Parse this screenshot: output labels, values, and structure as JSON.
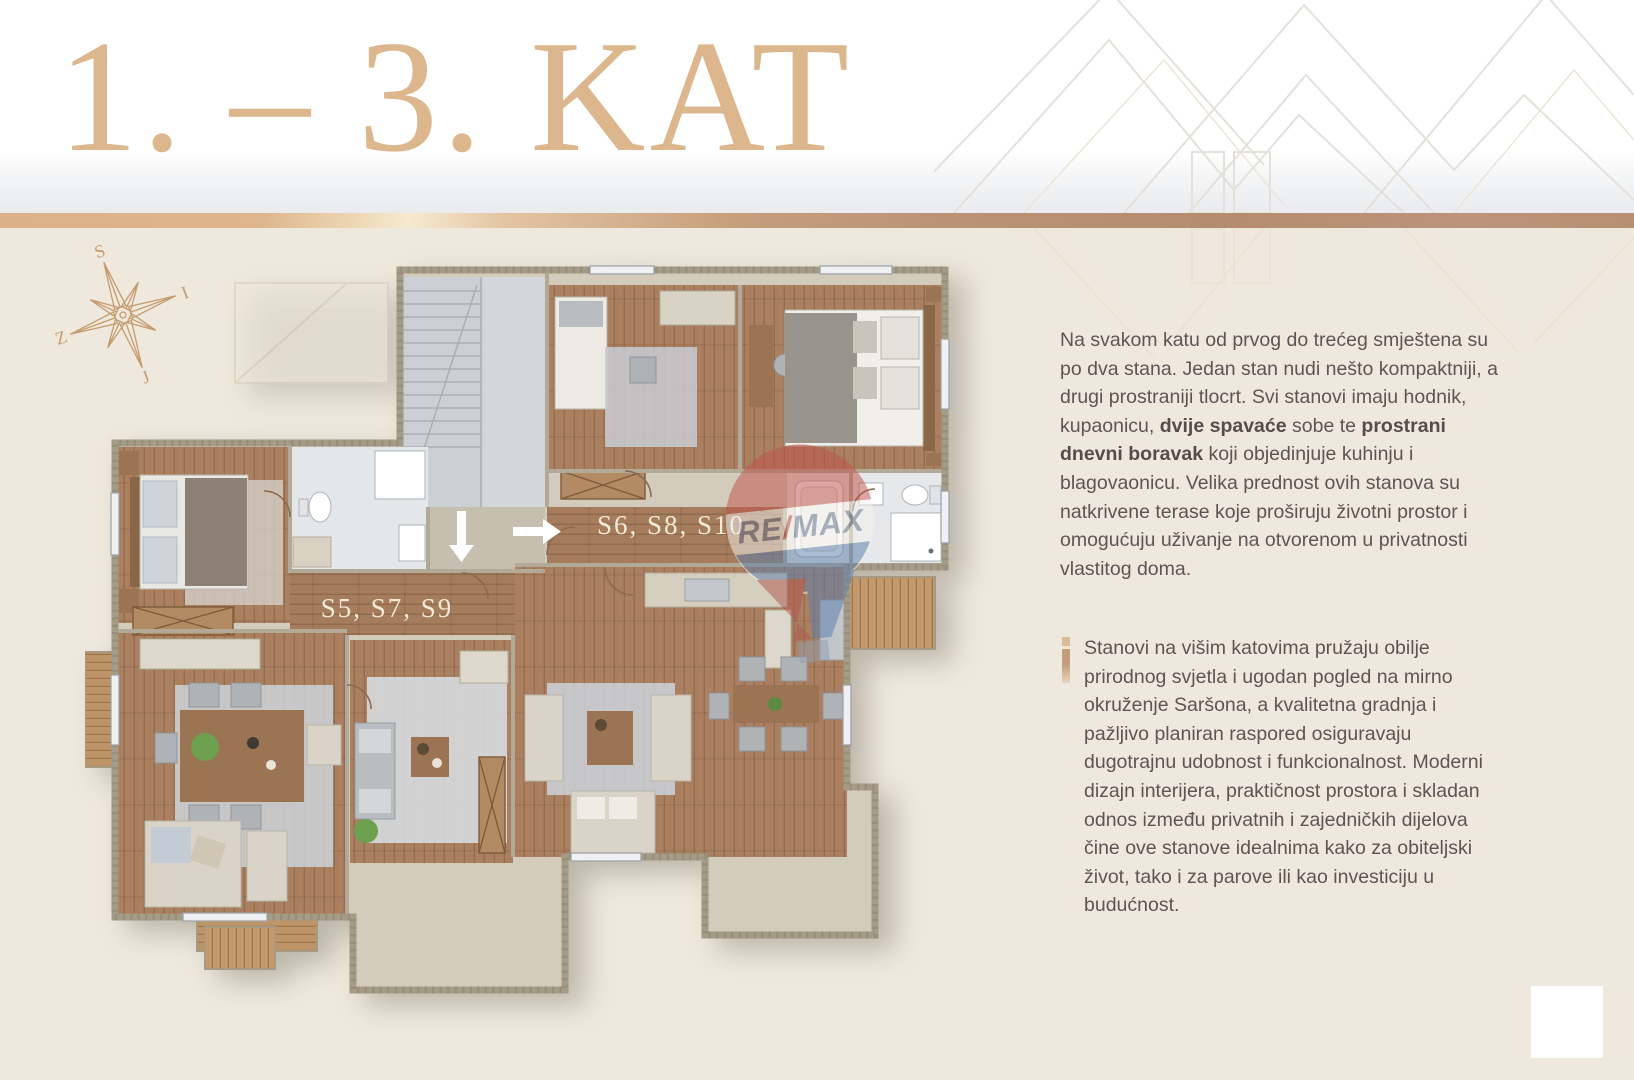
{
  "header": {
    "title": "1. – 3. KAT"
  },
  "palette": {
    "background": "#efe9dd",
    "title_color": "#dcb68d",
    "divider_copper": "#bb9276",
    "divider_gold": "#f7ead0",
    "body_text": "#5e5454",
    "accent_bar": "#c9a585",
    "plan_label": "#f2ead7",
    "wood_floor": "#aa8060",
    "remax_red": "#c0534c",
    "remax_blue": "#5d7fae"
  },
  "compass": {
    "north": "S",
    "east": "I",
    "west": "Z",
    "south": "J"
  },
  "floorplan": {
    "left_unit_label": "S5, S7, S9",
    "right_unit_label": "S6, S8, S10",
    "watermark": {
      "re": "RE",
      "slash": "/",
      "max": "MAX"
    }
  },
  "sidebar": {
    "paragraph1_segments": [
      {
        "t": "Na svakom katu od prvog do trećeg smještena su po dva stana. Jedan stan nudi nešto kompaktniji, a drugi prostraniji tlocrt. Svi stanovi imaju hodnik, kupaonicu, ",
        "b": false
      },
      {
        "t": "dvije spavaće",
        "b": true
      },
      {
        "t": " sobe te ",
        "b": false
      },
      {
        "t": "prostrani dnevni boravak",
        "b": true
      },
      {
        "t": " koji objedinjuje kuhinju i blagovaonicu. Velika prednost ovih stanova su natkrivene terase koje proširuju životni prostor i omogućuju uživanje na otvorenom u privatnosti vlastitog doma.",
        "b": false
      }
    ],
    "paragraph2": "Stanovi na višim katovima pružaju obilje prirodnog svjetla i ugodan pogled na mirno okruženje Saršona, a kvalitetna gradnja i pažljivo planiran raspored osiguravaju dugotrajnu udobnost i funkcionalnost. Moderni dizajn interijera, praktičnost prostora i skladan odnos između privatnih i zajedničkih dijelova čine ove stanove idealnima kako za obiteljski život, tako i za parove ili kao investiciju u budućnost."
  }
}
